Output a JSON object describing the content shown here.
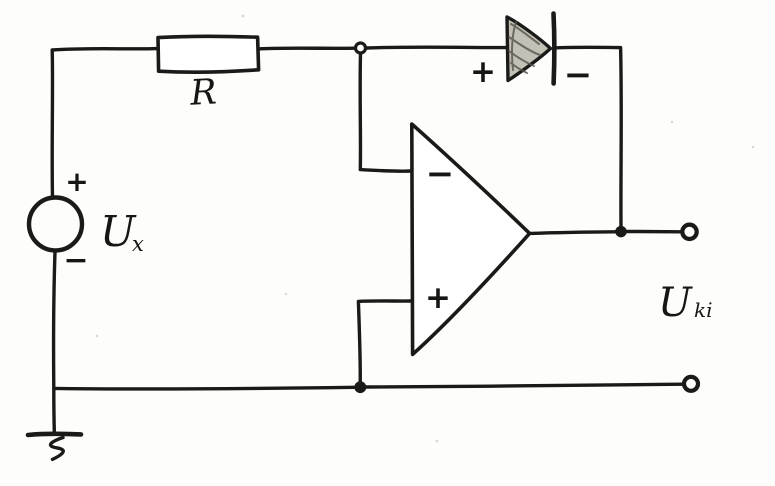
{
  "colors": {
    "ink": "#1a1a18",
    "paper": "#fdfdfb",
    "diode_fill": "#c3c0b6"
  },
  "labels": {
    "resistor": "R",
    "source": {
      "name": "U",
      "sub": "x",
      "plus": "+",
      "minus": "−"
    },
    "diode": {
      "plus": "+",
      "minus": "−"
    },
    "opamp": {
      "inverting": "−",
      "noninverting": "+"
    },
    "output": {
      "name": "U",
      "sub": "ki"
    }
  }
}
